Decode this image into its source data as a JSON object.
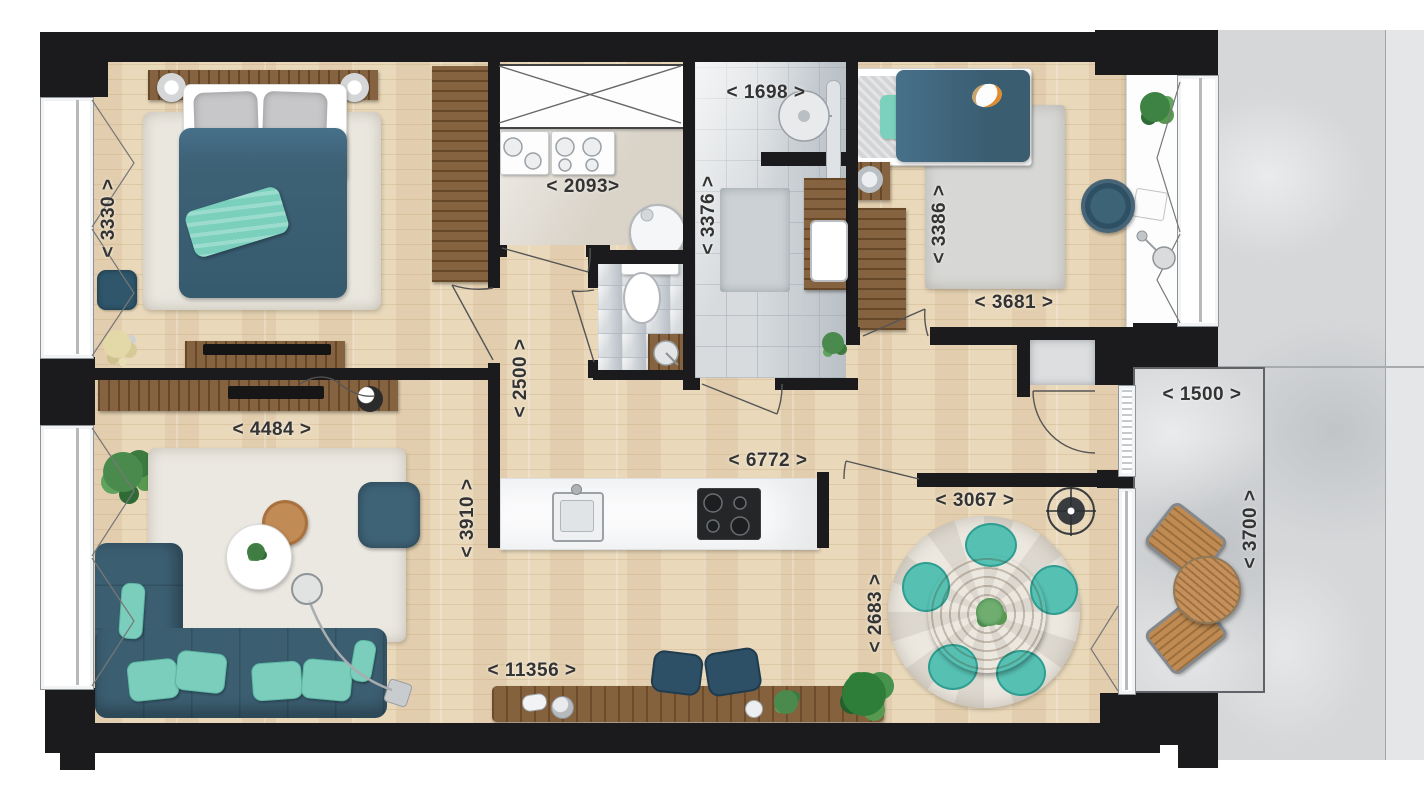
{
  "plan": {
    "type": "apartment-floor-plan",
    "dimensions_unit": "mm",
    "dims": {
      "d3330": {
        "text": "< 3330 >",
        "mm": 3330,
        "area": "bedroom-1-depth"
      },
      "d1698": {
        "text": "< 1698 >",
        "mm": 1698,
        "area": "bathroom-width"
      },
      "d2093": {
        "text": "< 2093>",
        "mm": 2093,
        "area": "utility-width"
      },
      "d3376": {
        "text": "< 3376 >",
        "mm": 3376,
        "area": "bathroom-depth"
      },
      "d3386": {
        "text": "< 3386 >",
        "mm": 3386,
        "area": "bedroom-2-depth"
      },
      "d3681": {
        "text": "< 3681 >",
        "mm": 3681,
        "area": "bedroom-2-width"
      },
      "d2500": {
        "text": "< 2500 >",
        "mm": 2500,
        "area": "hall-width"
      },
      "d4484": {
        "text": "< 4484 >",
        "mm": 4484,
        "area": "living-room-width"
      },
      "d6772": {
        "text": "< 6772 >",
        "mm": 6772,
        "area": "corridor-length"
      },
      "d3910": {
        "text": "< 3910 >",
        "mm": 3910,
        "area": "living-room-depth"
      },
      "d1500": {
        "text": "< 1500 >",
        "mm": 1500,
        "area": "balcony-width"
      },
      "d3700": {
        "text": "< 3700 >",
        "mm": 3700,
        "area": "balcony-depth"
      },
      "d3067": {
        "text": "< 3067 >",
        "mm": 3067,
        "area": "dining-width"
      },
      "d2683": {
        "text": "< 2683 >",
        "mm": 2683,
        "area": "dining-depth"
      },
      "d11356": {
        "text": "< 11356 >",
        "mm": 11356,
        "area": "apartment-total-width"
      }
    },
    "palette": {
      "wall": "#1b1b1d",
      "wood_floor": "#e9d8ba",
      "furniture_wood": "#7d5731",
      "teal_upholstery": "#3d6175",
      "mint_accent": "#7bcebb",
      "tile": "#d3d7da",
      "concrete": "#d5d7d9"
    }
  }
}
